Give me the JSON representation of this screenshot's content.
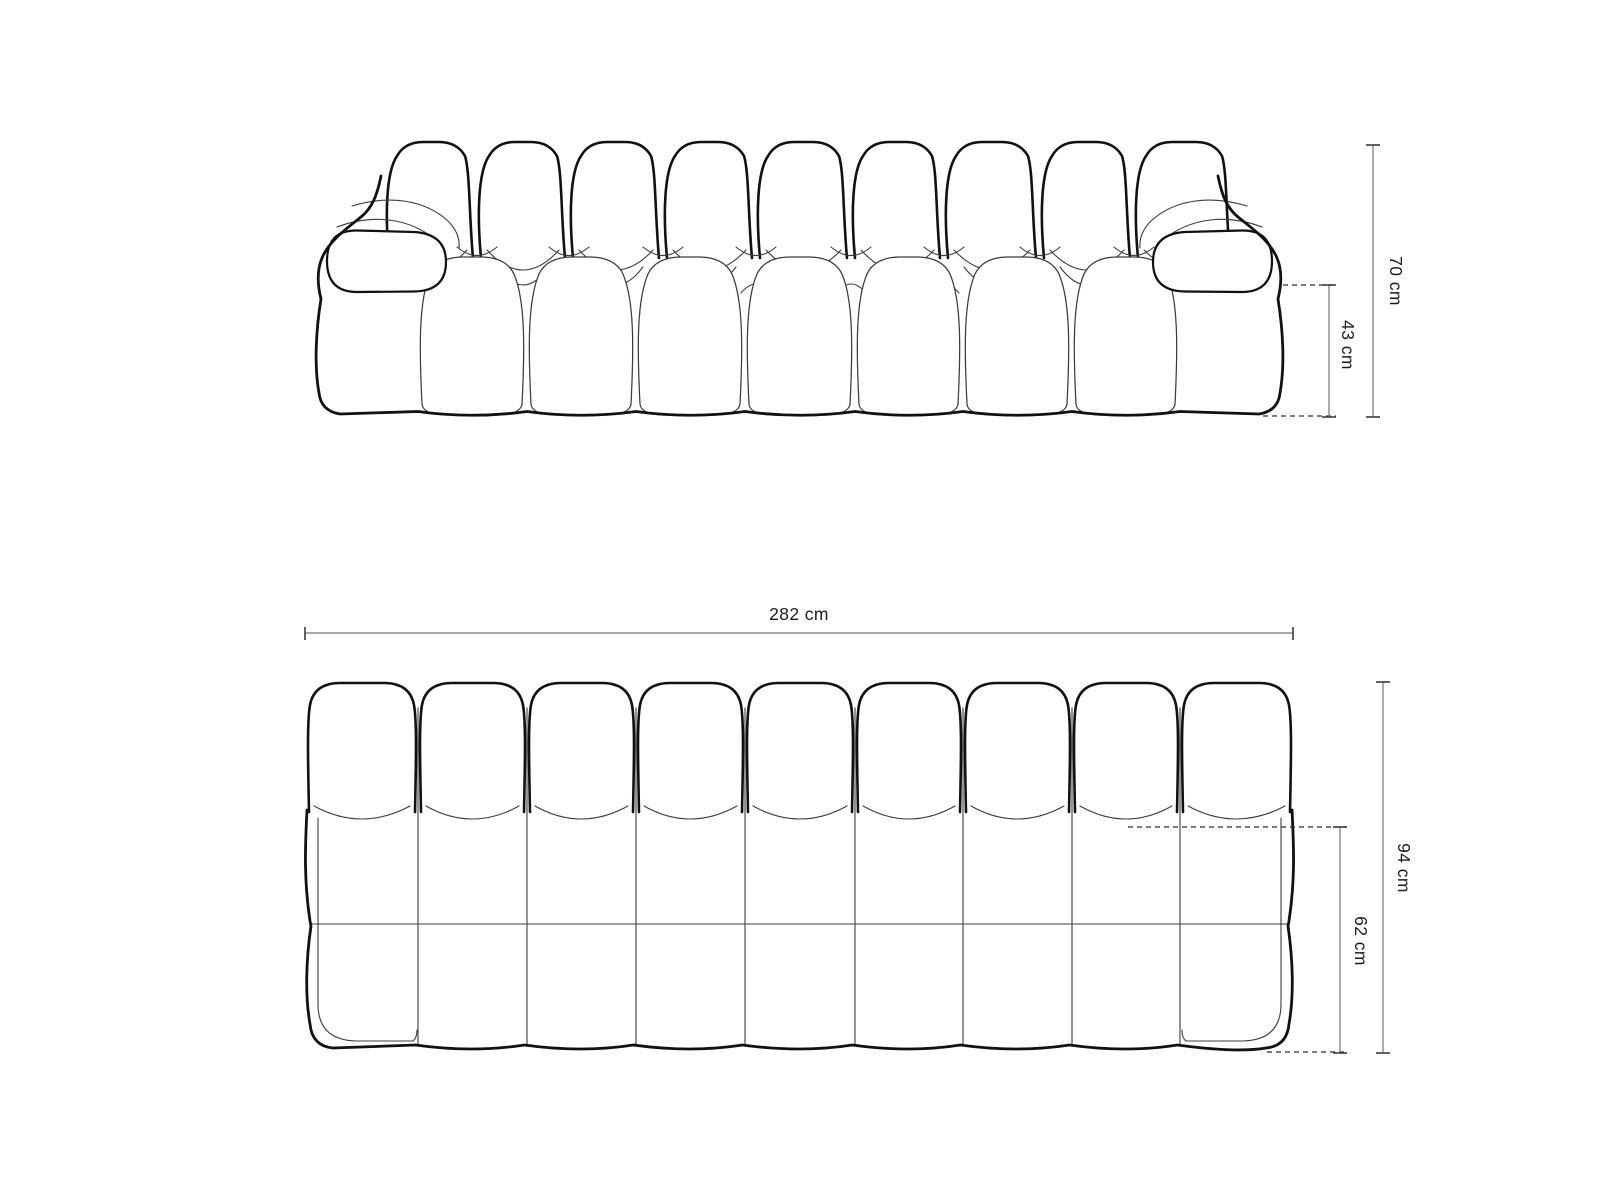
{
  "drawing": {
    "title": "Modular bubble sofa technical drawing",
    "views": {
      "front": {
        "name": "front-elevation"
      },
      "top": {
        "name": "top-plan"
      }
    }
  },
  "dimensions": {
    "front_total_height": {
      "label": "70 cm"
    },
    "front_seat_height": {
      "label": "43 cm"
    },
    "top_total_width": {
      "label": "282 cm"
    },
    "top_total_depth": {
      "label": "94 cm"
    },
    "top_seat_depth": {
      "label": "62 cm"
    }
  },
  "style": {
    "outline_color": "#111111",
    "thin_line_color": "#3c3c3c",
    "dimension_line_color": "#8a8a8a",
    "tick_color": "#3c3c3c",
    "dashed_line_color": "#2e2e2e",
    "text_color": "#1c1c1c",
    "background_color": "#ffffff"
  }
}
